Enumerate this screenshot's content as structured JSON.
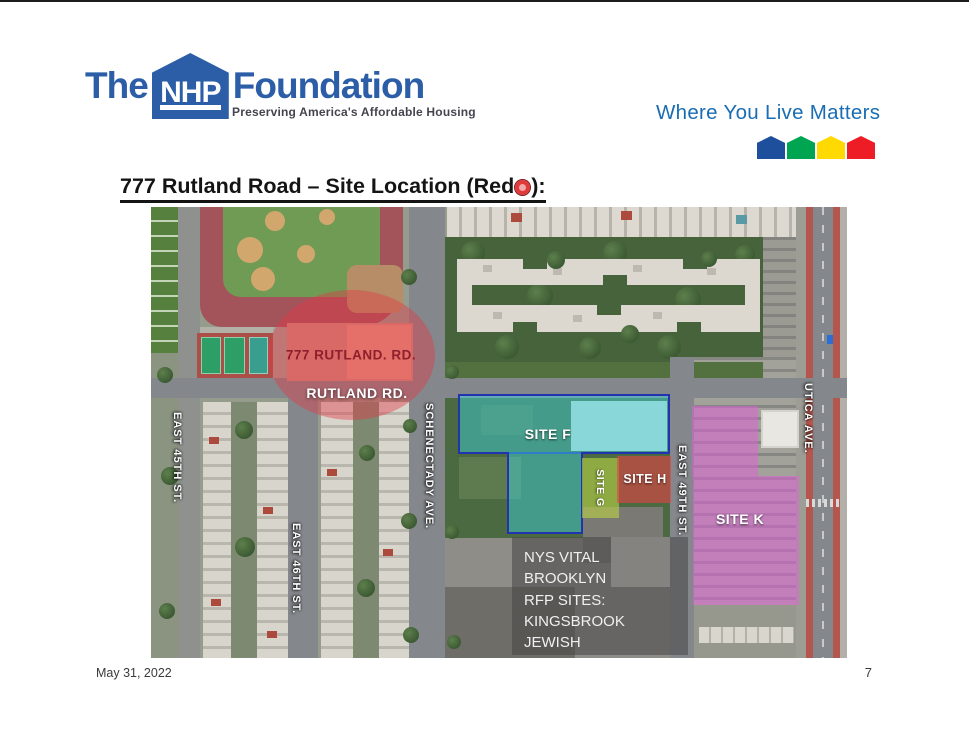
{
  "header": {
    "logo": {
      "the": "The",
      "nhp": "NHP",
      "foundation": "Foundation",
      "tagline": "Preserving America's Affordable Housing"
    },
    "motto": "Where You Live Matters",
    "house_colors": [
      "#1d4f9d",
      "#00a552",
      "#ffd902",
      "#ee1c25"
    ]
  },
  "colors": {
    "brand_blue": "#2b5ea7",
    "motto_blue": "#1a6db3",
    "site_f_fill": "rgba(62,214,226,0.45)",
    "site_f_border": "#2333b0",
    "site_g_fill": "rgba(186,214,66,0.60)",
    "site_h_fill": "rgba(224,68,68,0.62)",
    "site_k_fill": "rgba(221,99,214,0.55)",
    "highlight_red": "rgba(228,56,68,0.42)"
  },
  "title": {
    "prefix": "777 Rutland Road – Site Location (Red",
    "suffix": "):"
  },
  "map": {
    "streets": {
      "east45": "EAST 45TH ST.",
      "east46": "EAST 46TH ST.",
      "schenectady": "SCHENECTADY AVE.",
      "east49": "EAST 49TH ST.",
      "utica": "UTICA AVE."
    },
    "sites": {
      "f": "SITE F",
      "g": "SITE G",
      "h": "SITE H",
      "k": "SITE K"
    },
    "rutland": {
      "building_label": "777 RUTLAND. RD.",
      "road_label": "RUTLAND RD."
    },
    "info_box": {
      "lines": [
        "NYS VITAL BROOKLYN",
        "RFP SITES:",
        "KINGSBROOK JEWISH",
        "MEDICAL CENTER"
      ]
    }
  },
  "footer": {
    "date": "May 31, 2022",
    "page": "7"
  }
}
